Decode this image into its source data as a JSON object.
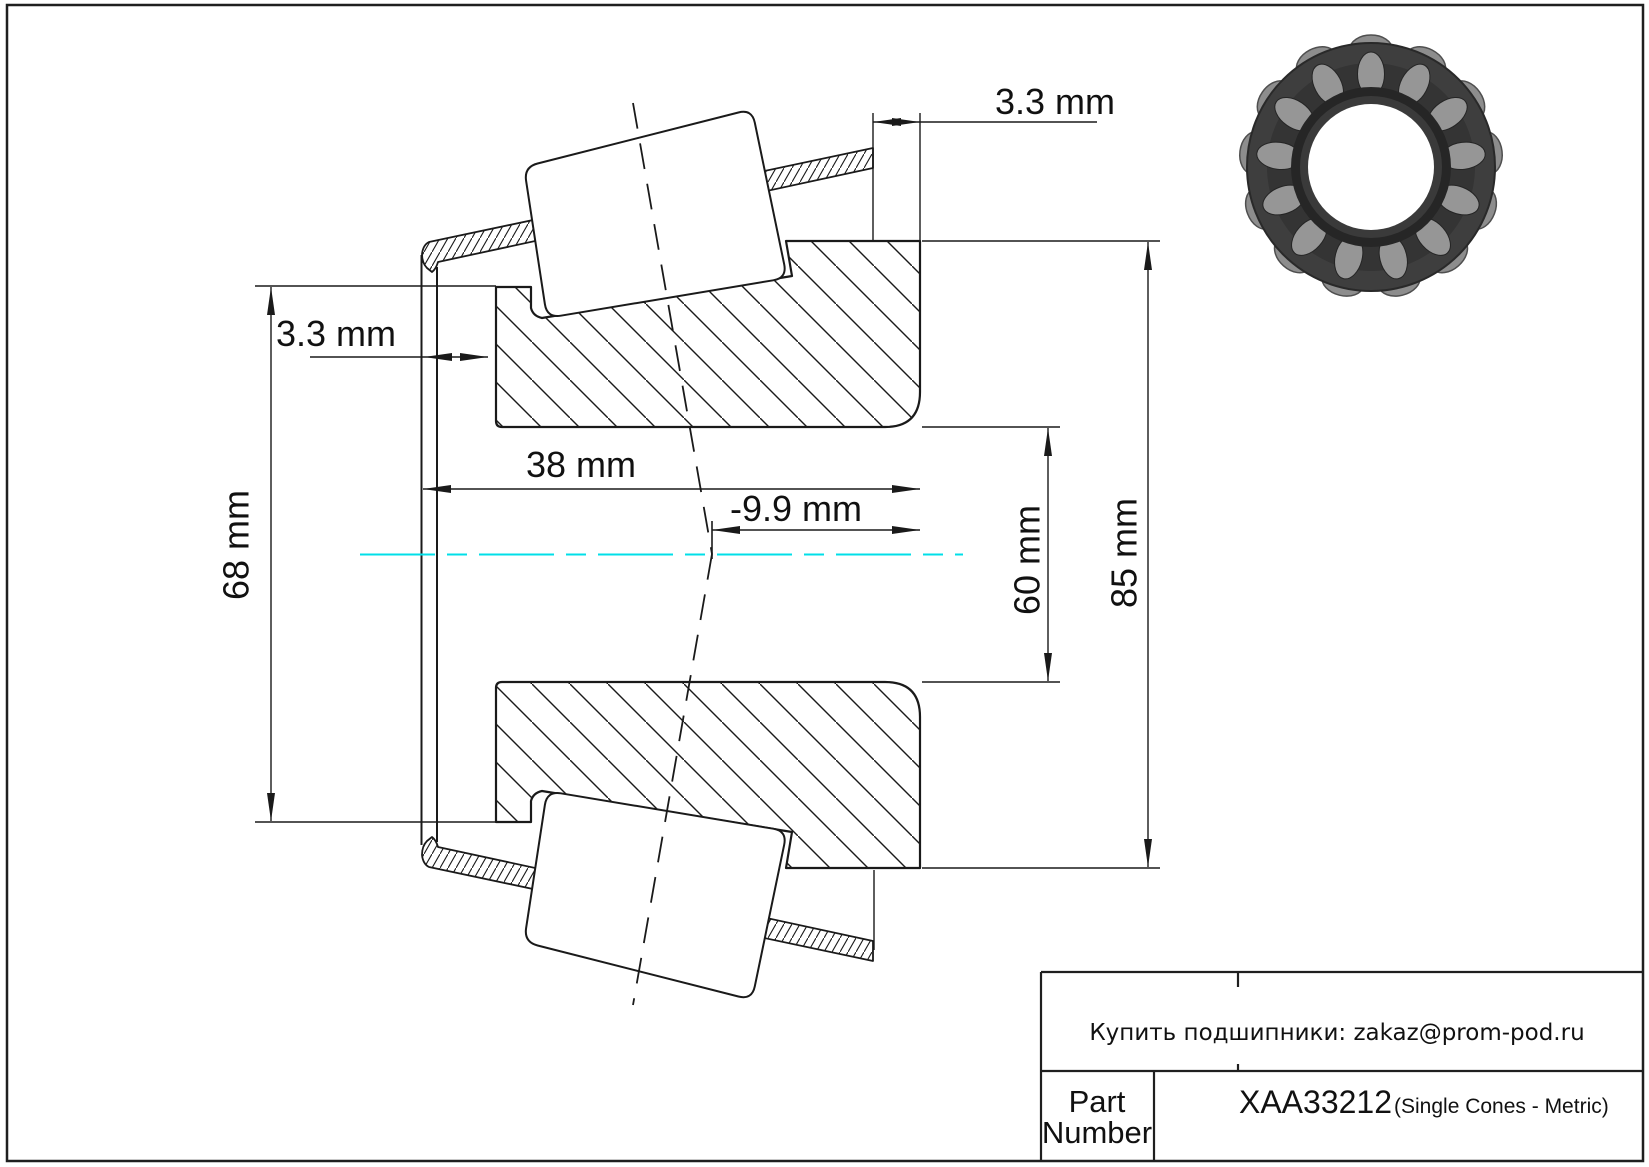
{
  "drawing": {
    "dims": {
      "top_offset": "3.3 mm",
      "left_offset": "3.3 mm",
      "left_diameter": "68 mm",
      "width": "38 mm",
      "center_offset": "-9.9 mm",
      "bore": "60 mm",
      "outer_diameter": "85 mm"
    },
    "centerline_color": "#00dfe8",
    "line_color": "#1a1a1a"
  },
  "title_block": {
    "note": "Купить подшипники: zakaz@prom-pod.ru",
    "part_label_line1": "Part",
    "part_label_line2": "Number",
    "part_number": "XAA33212",
    "part_type": "(Single Cones - Metric)"
  }
}
